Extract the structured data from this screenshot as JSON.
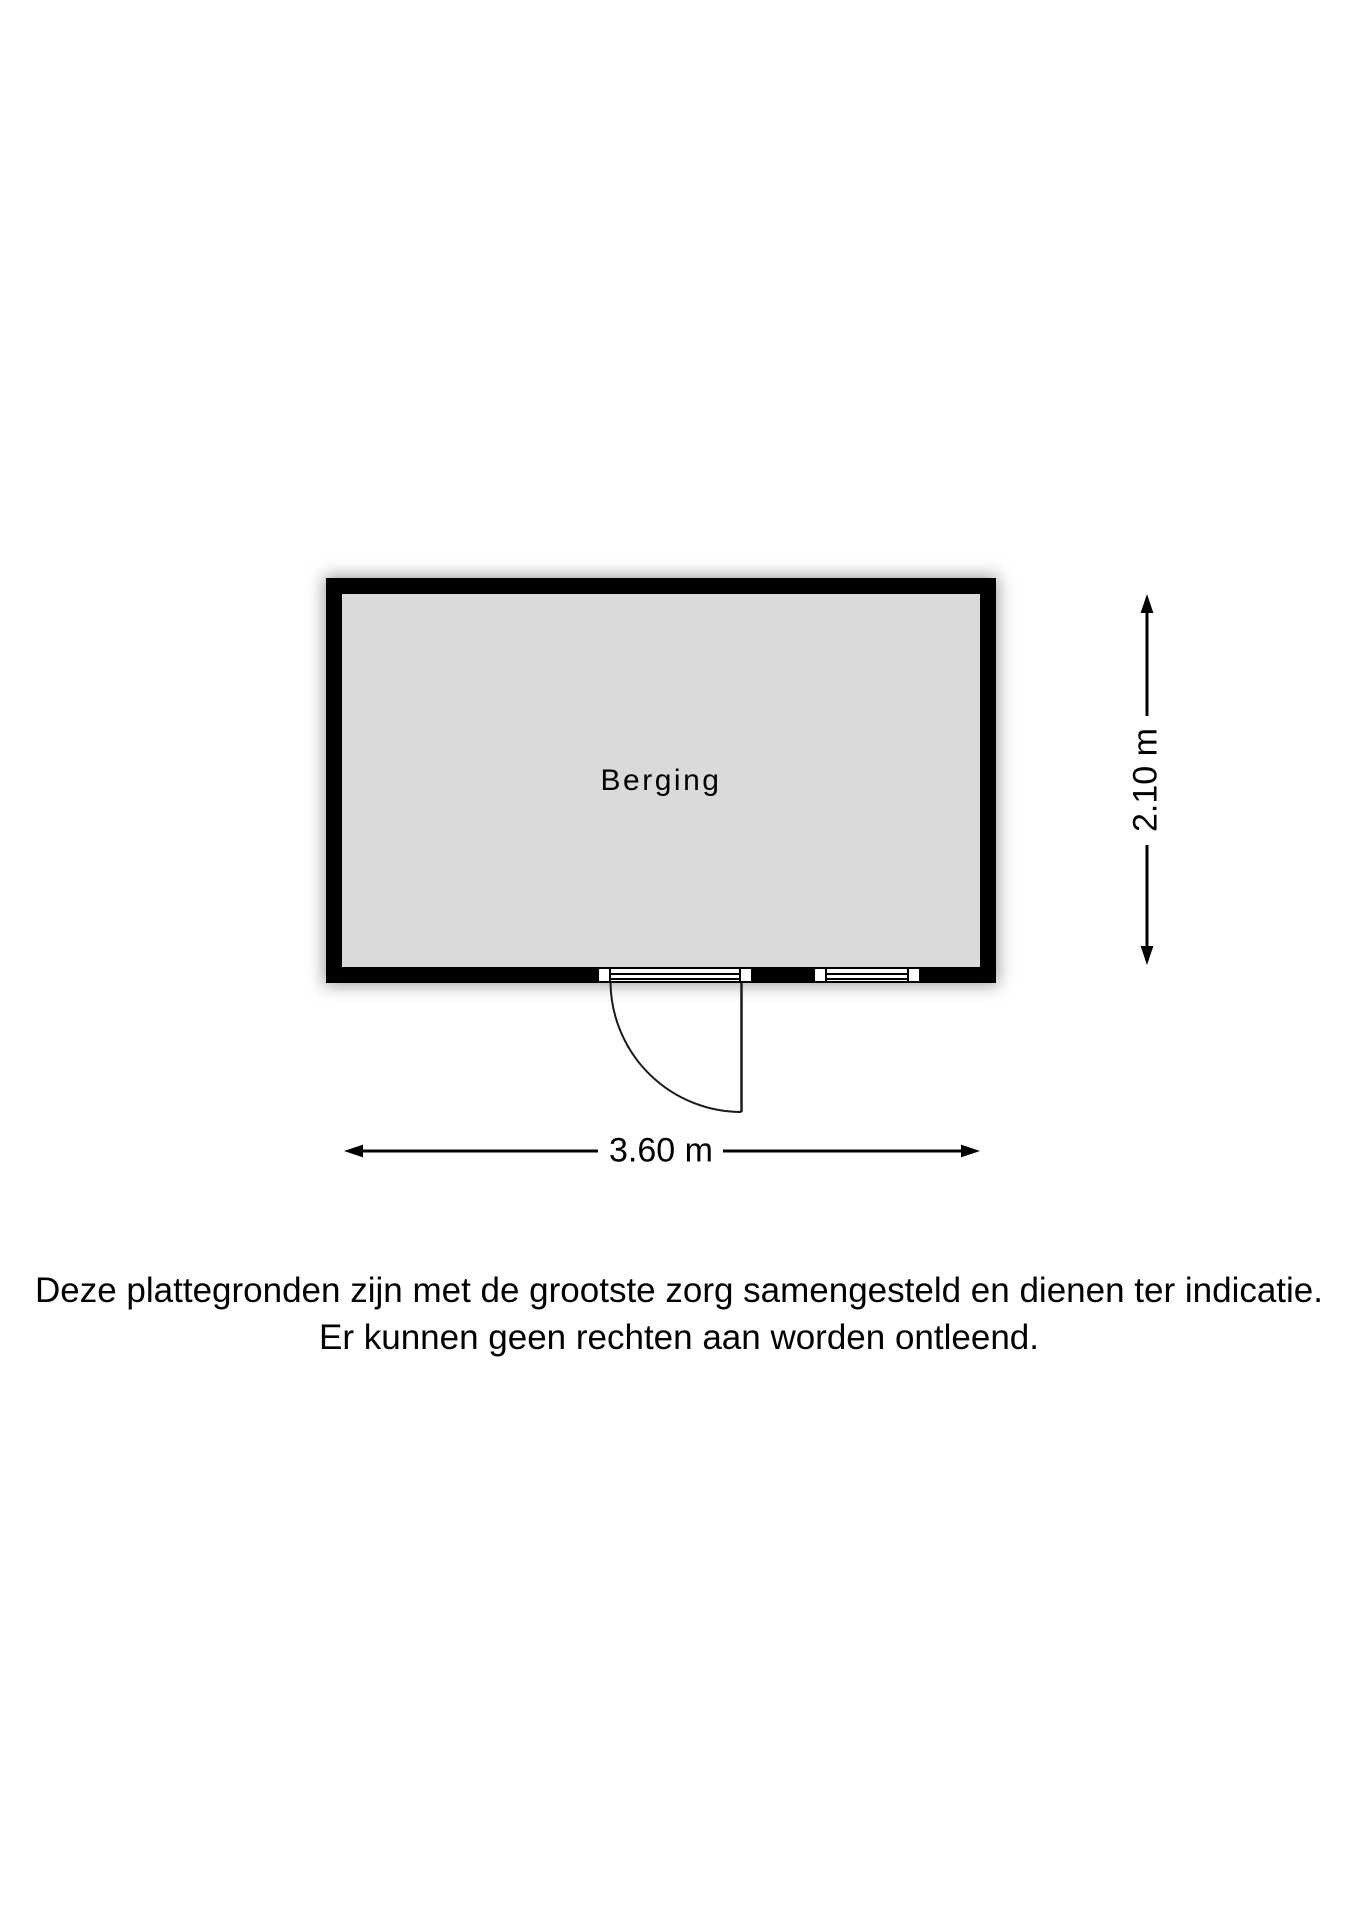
{
  "floorplan": {
    "room": {
      "label": "Berging"
    },
    "dimensions": {
      "width_label": "3.60 m",
      "height_label": "2.10 m"
    },
    "features": {
      "door": "swing-door-bottom-wall",
      "window": "window-bottom-wall"
    },
    "colors": {
      "wall": "#000000",
      "floor": "#dadada",
      "background": "#ffffff",
      "text": "#000000"
    }
  },
  "disclaimer": {
    "line1": "Deze plattegronden zijn met de grootste zorg samengesteld en dienen ter indicatie.",
    "line2": "Er kunnen geen rechten aan worden ontleend."
  }
}
